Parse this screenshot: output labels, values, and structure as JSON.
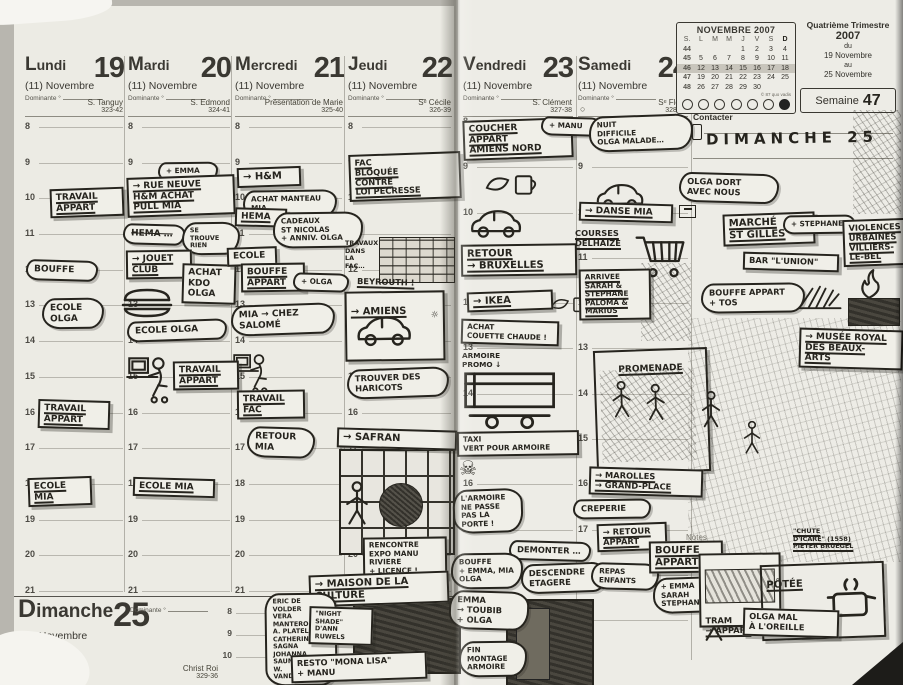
{
  "colors": {
    "ink": "#26241e",
    "paper": "#ecebe4",
    "shade": "#c8c5bc"
  },
  "left_page": {
    "days": [
      {
        "name": "Lundi",
        "number": "19",
        "month": "(11) Novembre",
        "dominante": "Dominante °",
        "saint": "S. Tanguy",
        "ref": "323-42"
      },
      {
        "name": "Mardi",
        "number": "20",
        "month": "(11) Novembre",
        "dominante": "Dominante °",
        "saint": "S. Edmond",
        "ref": "324-41"
      },
      {
        "name": "Mercredi",
        "number": "21",
        "month": "(11) Novembre",
        "dominante": "Dominante °",
        "saint": "Présentation de Marie",
        "ref": "325-40"
      },
      {
        "name": "Jeudi",
        "number": "22",
        "month": "(11) Novembre",
        "dominante": "Dominante °",
        "saint": "Sᵉ Cécile",
        "ref": "326-39"
      }
    ],
    "hours": [
      "8",
      "9",
      "10",
      "11",
      "12",
      "13",
      "14",
      "15",
      "16",
      "17",
      "18",
      "19",
      "20",
      "21"
    ],
    "sunday": {
      "name": "Dimanche",
      "number": "25",
      "month": "(11) Novembre",
      "dominante": "Dominante °",
      "saint": "Christ Roi",
      "ref": "329-36",
      "hours": [
        "8",
        "9",
        "10"
      ],
      "extra_hour": "12"
    }
  },
  "right_page": {
    "days": [
      {
        "name": "Vendredi",
        "number": "23",
        "month": "(11) Novembre",
        "dominante": "Dominante °",
        "saint": "S. Clément",
        "ref": "327-38"
      },
      {
        "name": "Samedi",
        "number": "24",
        "month": "(11) Novembre",
        "dominante": "Dominante °",
        "saint": "Sᵉ Flora",
        "ref": "328-37",
        "moon": "○"
      }
    ],
    "hours": [
      "8",
      "9",
      "10",
      "11",
      "12",
      "13",
      "14",
      "15",
      "16",
      "17",
      "18",
      "19"
    ],
    "calendar": {
      "title": "NOVEMBRE 2007",
      "headers": [
        "S.",
        "L",
        "M",
        "M",
        "J",
        "V",
        "S",
        "D"
      ],
      "rows": [
        {
          "w": "44",
          "c0": "",
          "c1": "",
          "c2": "",
          "c3": "1",
          "c4": "2",
          "c5": "3",
          "c6": "4"
        },
        {
          "w": "45",
          "c0": "5",
          "c1": "6",
          "c2": "7",
          "c3": "8",
          "c4": "9",
          "c5": "10",
          "c6": "11"
        },
        {
          "w": "46",
          "cls": "shaded",
          "c0": "12",
          "c1": "13",
          "c2": "14",
          "c3": "15",
          "c4": "16",
          "c5": "17",
          "c6": "18"
        },
        {
          "w": "47",
          "c0": "19",
          "c1": "20",
          "c2": "21",
          "c3": "22",
          "c4": "23",
          "c5": "24",
          "c6": "25"
        },
        {
          "w": "48",
          "c0": "26",
          "c1": "27",
          "c2": "28",
          "c3": "29",
          "c4": "30",
          "c5": "",
          "c6": ""
        }
      ],
      "copyright": "© 87 quo vadis",
      "day_markers": [
        {
          "n": "1"
        },
        {
          "n": "2"
        },
        {
          "n": "3"
        },
        {
          "n": "4"
        },
        {
          "n": "5"
        },
        {
          "n": "6"
        },
        {
          "n": "7",
          "cls": "filled"
        }
      ]
    },
    "trimester": {
      "line1": "Quatrième Trimestre",
      "year": "2007",
      "du": "du",
      "from": "19 Novembre",
      "au": "au",
      "to": "25 Novembre"
    },
    "week": {
      "label": "Semaine",
      "number": "47"
    },
    "contact_label": "Contacter",
    "notes_label": "Notes"
  },
  "notes": {
    "lundi": [
      {
        "text": "TRAVAIL\nAPPART"
      },
      {
        "text": "BOUFFE"
      },
      {
        "text": "ECOLE\nOLGA"
      },
      {
        "text": "TRAVAIL\nAPPART"
      },
      {
        "text": "ECOLE\nMIA"
      }
    ],
    "mardi": [
      {
        "text": "+ EMMA"
      },
      {
        "text": "→ RUE NEUVE\nH&M ACHAT\nPULL MIA"
      },
      {
        "text": "HEMA …"
      },
      {
        "text": "SE\nTROUVE\nRIEN"
      },
      {
        "text": "→ JOUET\nCLUB"
      },
      {
        "text": "ACHAT\nKDO\nOLGA"
      },
      {
        "text": "ECOLE OLGA"
      },
      {
        "text": "TRAVAIL\nAPPART"
      },
      {
        "text": "ECOLE MIA"
      }
    ],
    "mercredi": [
      {
        "text": "→ H&M"
      },
      {
        "text": "ACHAT MANTEAU\nMIA"
      },
      {
        "text": "HEMA"
      },
      {
        "text": "CADEAUX\nST NICOLAS\n+ ANNIV. OLGA"
      },
      {
        "text": "ECOLE"
      },
      {
        "text": "BOUFFE\nAPPART"
      },
      {
        "text": "+ OLGA"
      },
      {
        "text": "MIA → CHEZ\nSALOMÉ"
      },
      {
        "text": "TRAVAIL\nFAC"
      },
      {
        "text": "RETOUR\nMIA"
      }
    ],
    "jeudi": [
      {
        "text": "FAC\nBLOQUÉE\nCONTRE\nLOI PECRESSE"
      },
      {
        "text": "TRAVAUX\nDANS\nLA\nFAC…"
      },
      {
        "text": "BEYROUTH !"
      },
      {
        "text": "→ AMIENS"
      },
      {
        "text": "TROUVER DES\nHARICOTS"
      },
      {
        "text": "→ SAFRAN"
      },
      {
        "text": "RENCONTRE\nEXPO MANU\nRIVIERE\n+ LICENCE !"
      },
      {
        "text": "→ MAISON DE LA\nCULTURE"
      },
      {
        "text": "ERIC DE\nVOLDER\nVERA\nMANTERO\nA. PLATEL\nCATHERINE\nSAGNA\nJOHANNA\nSAUNIER\nW. VANDEKEYBUS"
      },
      {
        "text": "\"NIGHT\nSHADE\"\nD'ANN RUWELS"
      },
      {
        "text": "RESTO \"MONA LISA\"\n+ MANU"
      }
    ],
    "vendredi": [
      {
        "text": "COUCHER\nAPPART\nAMIENS NORD"
      },
      {
        "text": "+ MANU"
      },
      {
        "text": "RETOUR\n→ BRUXELLES"
      },
      {
        "text": "→ IKEA"
      },
      {
        "text": "ACHAT\nCOUETTE CHAUDE !"
      },
      {
        "text": "ARMOIRE\nPROMO ↓"
      },
      {
        "text": "TAXI\nVERT POUR ARMOIRE"
      },
      {
        "text": "L'ARMOIRE\nNE PASSE\nPAS LA\nPORTE !"
      },
      {
        "text": "DEMONTER …"
      },
      {
        "text": "BOUFFE\n+ EMMA, MIA\nOLGA"
      },
      {
        "text": "DESCENDRE\nETAGERE"
      },
      {
        "text": "EMMA\n→ TOUBIB\n+ OLGA"
      },
      {
        "text": "FIN\nMONTAGE\nARMOIRE"
      }
    ],
    "samedi": [
      {
        "text": "NUIT\nDIFFICILE\nOLGA MALADE…"
      },
      {
        "text": "→ DANSE MIA"
      },
      {
        "text": "COURSES\nDELHAIZE"
      },
      {
        "text": "ARRIVEE\nSARAH &\nSTEPHANE\nPALOMA &\nMARIUS"
      },
      {
        "text": "PROMENADE"
      },
      {
        "text": "→ MAROLLES\n→ GRAND-PLACE"
      },
      {
        "text": "CREPERIE"
      },
      {
        "text": "→ RETOUR\nAPPART"
      },
      {
        "text": "REPAS\nENFANTS"
      },
      {
        "text": "BOUFFE\nAPPART"
      },
      {
        "text": "+ EMMA\nSARAH\nSTEPHANE"
      }
    ],
    "dimanche": [
      {
        "text": "DIMANCHE 25"
      },
      {
        "text": "OLGA DORT\nAVEC NOUS"
      },
      {
        "text": "MARCHÉ\nST GILLES"
      },
      {
        "text": "+ STEPHANE"
      },
      {
        "text": "BAR \"L'UNION\""
      },
      {
        "text": "VIOLENCES\nURBAINES\nVILLIERS-\nLE-BEL"
      },
      {
        "text": "BOUFFE APPART\n+ TOS"
      },
      {
        "text": "→ MUSÉE ROYAL\nDES BEAUX-\nARTS"
      },
      {
        "text": "\"CHUTE\nD'ICARE\" (1558)\nPIETER BRUEGEL"
      },
      {
        "text": "TRAM\n→ APPART"
      },
      {
        "text": "PÔTÉE"
      },
      {
        "text": "OLGA MAL\nÀ L'OREILLE"
      }
    ]
  }
}
